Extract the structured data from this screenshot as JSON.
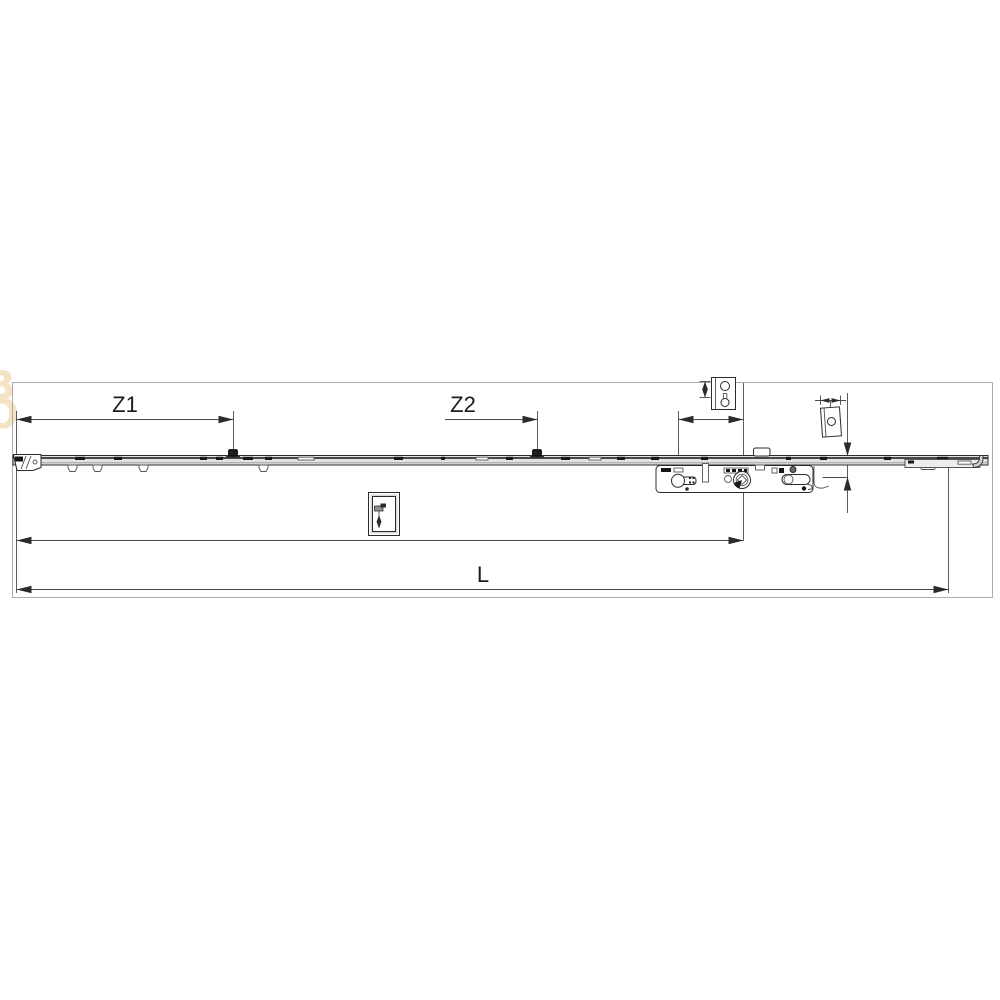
{
  "colors": {
    "line": "#2b2b2b",
    "mid": "#555555",
    "soft": "#999999",
    "frame": "#ababab",
    "rail_fill": "#e3e3e3",
    "dark_fill": "#161616",
    "white": "#ffffff",
    "watermark": "#f4e3c4"
  },
  "watermark": {
    "letters": [
      "B",
      "O"
    ]
  },
  "dimensions": {
    "z1": {
      "label": "Z1"
    },
    "z2": {
      "label": "Z2"
    },
    "length": {
      "label": "L"
    }
  }
}
